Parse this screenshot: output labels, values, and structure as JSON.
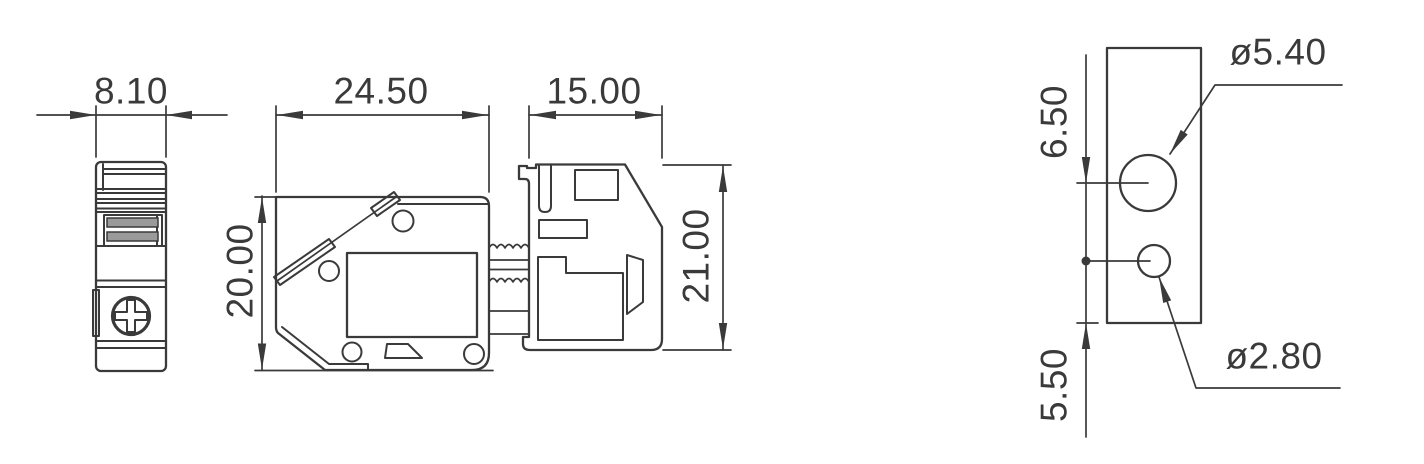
{
  "drawing": {
    "type": "engineering-dimension-drawing",
    "units_implied": "mm",
    "colors": {
      "line": "#3a3a3a",
      "text": "#3a3a3a",
      "background": "#ffffff"
    },
    "side_view": {
      "width_dim": "8.10"
    },
    "front_view": {
      "width_dim": "24.50",
      "height_dim": "20.00"
    },
    "connector_view": {
      "width_dim": "15.00",
      "height_dim": "21.00"
    },
    "hole_detail_view": {
      "upper_offset_dim": "6.50",
      "lower_offset_dim": "5.50",
      "large_hole_dia": "ø5.40",
      "small_hole_dia": "ø2.80"
    }
  }
}
